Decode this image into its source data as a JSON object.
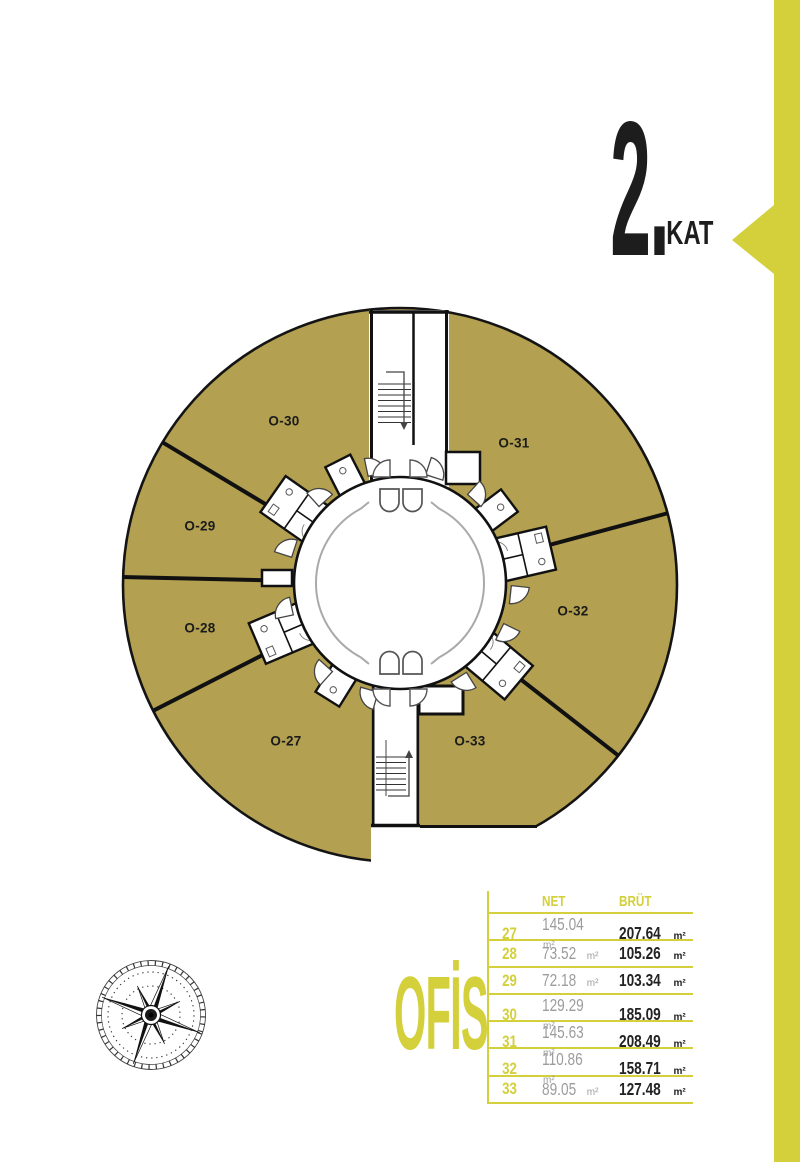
{
  "accent_colors": {
    "yellow": "#d3d03c",
    "gold": "#b3a050"
  },
  "title": {
    "number": "2.",
    "suffix": "KAT"
  },
  "plan": {
    "units": [
      {
        "label": "O-27"
      },
      {
        "label": "O-28"
      },
      {
        "label": "O-29"
      },
      {
        "label": "O-30"
      },
      {
        "label": "O-31"
      },
      {
        "label": "O-32"
      },
      {
        "label": "O-33"
      }
    ]
  },
  "legend": {
    "label": "OFİS"
  },
  "table": {
    "headers": {
      "net": "NET",
      "brut": "BRÜT"
    },
    "unit": "m²",
    "rows": [
      {
        "no": "27",
        "net": "145.04",
        "brut": "207.64"
      },
      {
        "no": "28",
        "net": "73.52",
        "brut": "105.26"
      },
      {
        "no": "29",
        "net": "72.18",
        "brut": "103.34"
      },
      {
        "no": "30",
        "net": "129.29",
        "brut": "185.09"
      },
      {
        "no": "31",
        "net": "145.63",
        "brut": "208.49"
      },
      {
        "no": "32",
        "net": "110.86",
        "brut": "158.71"
      },
      {
        "no": "33",
        "net": "89.05",
        "brut": "127.48"
      }
    ]
  }
}
